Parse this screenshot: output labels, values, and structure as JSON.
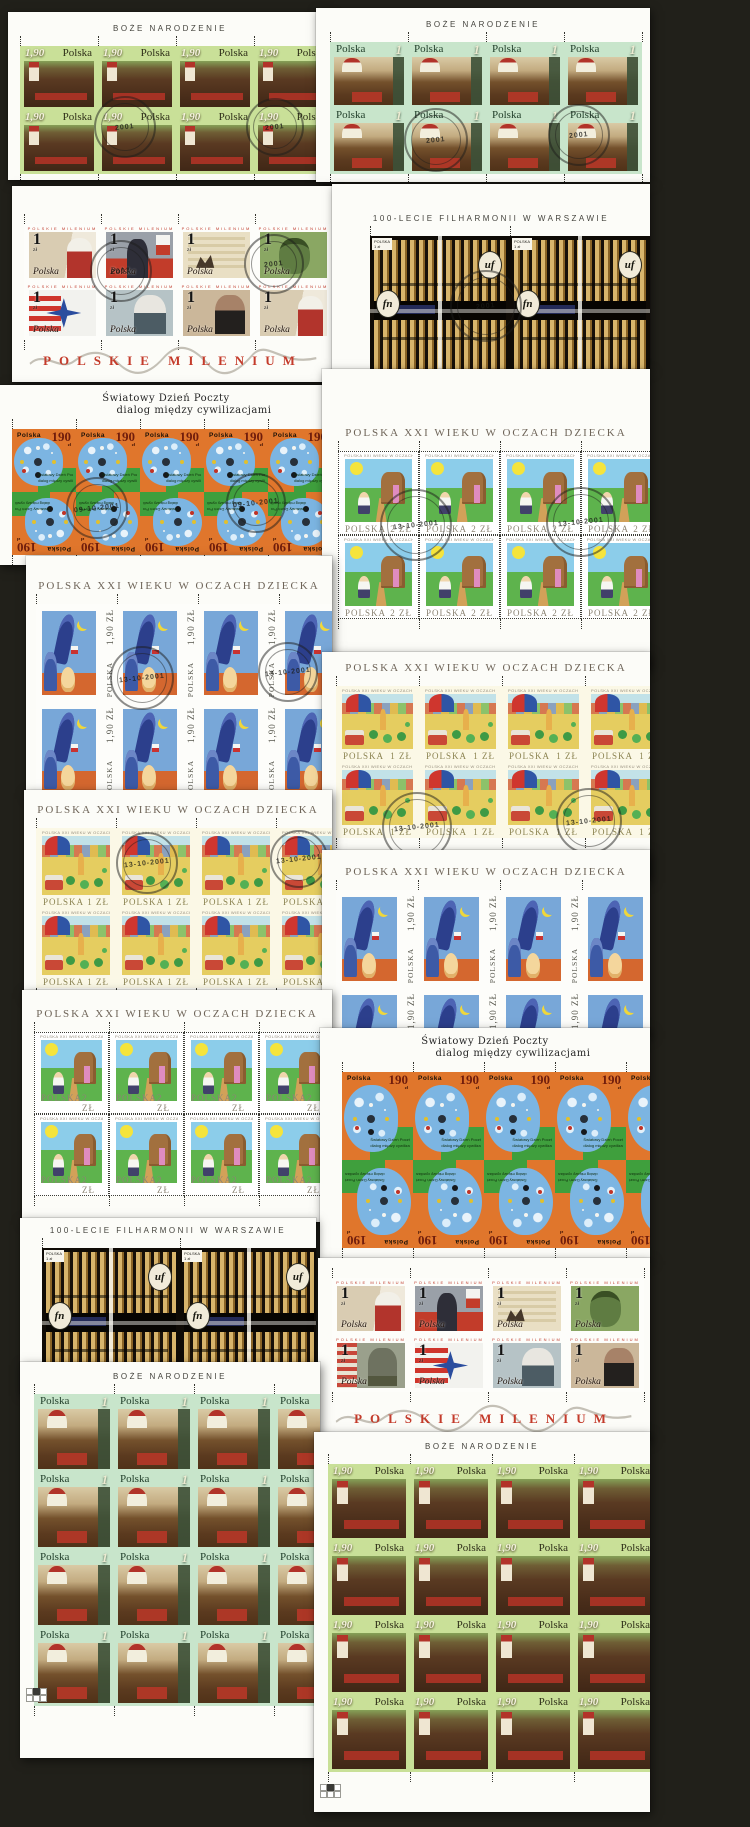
{
  "image_type": "scanned collage of cancelled Polish postage stamp sheets",
  "background_color": "#21201a",
  "titles": {
    "christmas": "BOŻE NARODZENIE",
    "philharmonic": "100-LECIE FILHARMONII W WARSZAWIE",
    "children": "POLSKA XXI WIEKU W OCZACH DZIECKA",
    "world_post_line1": "Światowy Dzień Poczty",
    "world_post_line2": "dialog między cywilizacjami",
    "milenium": "POLSKIE MILENIUM"
  },
  "stamp_text": {
    "country": "Polska",
    "country_caps": "POLSKA",
    "zl": "zł",
    "christmas_190_denom": "1,90",
    "christmas_1_denom": "1",
    "milenium_denom": "1",
    "world_post_denom": "190",
    "children_2zl_denom": "2 ZŁ",
    "children_1zl_denom": "1 ZŁ",
    "children_190_denom": "1,90 ZŁ",
    "philharmonic_denom": "1 zł",
    "philharmonic_badge_left": "fn",
    "philharmonic_badge_right": "uf"
  },
  "postmarks": {
    "date_main": "13-10-2001",
    "date_world": "09-10-2001",
    "year": "2001"
  },
  "sheets": [
    {
      "name": "christmas-190-top-left",
      "title_key": "christmas",
      "header_style": "sans",
      "design": "bn190",
      "cols": 5,
      "rows": 2,
      "postmarked": true
    },
    {
      "name": "christmas-1-top-right",
      "title_key": "christmas",
      "header_style": "sans",
      "design": "bn1",
      "cols": 4,
      "rows": 2,
      "postmarked": true
    },
    {
      "name": "milenium-left",
      "design": "mil",
      "cols": 5,
      "rows": 2,
      "caption_key": "milenium",
      "postmarked": true
    },
    {
      "name": "philharmonic-right",
      "title_key": "philharmonic",
      "header_style": "sans",
      "design": "fil",
      "cols": 2,
      "rows": 1,
      "postmarked": true
    },
    {
      "name": "world-post-day-left",
      "title_key": "world_post_line1",
      "title_key2": "world_post_line2",
      "header_style": "hand",
      "design": "sw",
      "cols": 5,
      "rows": 2,
      "flip_second_row": true,
      "postmarked": true
    },
    {
      "name": "children-2zl-right",
      "title_key": "children",
      "header_style": "serif",
      "design": "x2",
      "cols": 4,
      "rows": 2,
      "postmarked": true
    },
    {
      "name": "children-190-left",
      "title_key": "children",
      "header_style": "serif",
      "design": "rk",
      "cols": 4,
      "rows": 2,
      "postmarked": true
    },
    {
      "name": "children-1zl-right",
      "title_key": "children",
      "header_style": "serif",
      "design": "x1",
      "cols": 4,
      "rows": 2,
      "postmarked": true
    },
    {
      "name": "children-1zl-left",
      "title_key": "children",
      "header_style": "serif",
      "design": "x1",
      "cols": 4,
      "rows": 2,
      "postmarked": true
    },
    {
      "name": "children-190-right",
      "title_key": "children",
      "header_style": "serif",
      "design": "rk",
      "cols": 4,
      "rows": 2,
      "postmarked": false
    },
    {
      "name": "children-2zl-left",
      "title_key": "children",
      "header_style": "serif",
      "design": "x2",
      "cols": 4,
      "rows": 2,
      "postmarked": false
    },
    {
      "name": "world-post-day-right",
      "title_key": "world_post_line1",
      "title_key2": "world_post_line2",
      "header_style": "hand",
      "design": "sw",
      "cols": 5,
      "rows": 2,
      "flip_second_row": true,
      "postmarked": false
    },
    {
      "name": "philharmonic-left",
      "title_key": "philharmonic",
      "header_style": "sans",
      "design": "fil",
      "cols": 3,
      "rows": 1,
      "postmarked": false
    },
    {
      "name": "milenium-right",
      "design": "mil",
      "cols": 4,
      "rows": 2,
      "caption_key": "milenium",
      "postmarked": false
    },
    {
      "name": "christmas-1-bottom-left",
      "title_key": "christmas",
      "header_style": "sans",
      "design": "bn1",
      "cols": 4,
      "rows": 4,
      "postmarked": false,
      "registration_block": true
    },
    {
      "name": "christmas-190-bottom-right",
      "title_key": "christmas",
      "header_style": "sans",
      "design": "bn190",
      "cols": 4,
      "rows": 4,
      "postmarked": false,
      "registration_block": true
    }
  ]
}
